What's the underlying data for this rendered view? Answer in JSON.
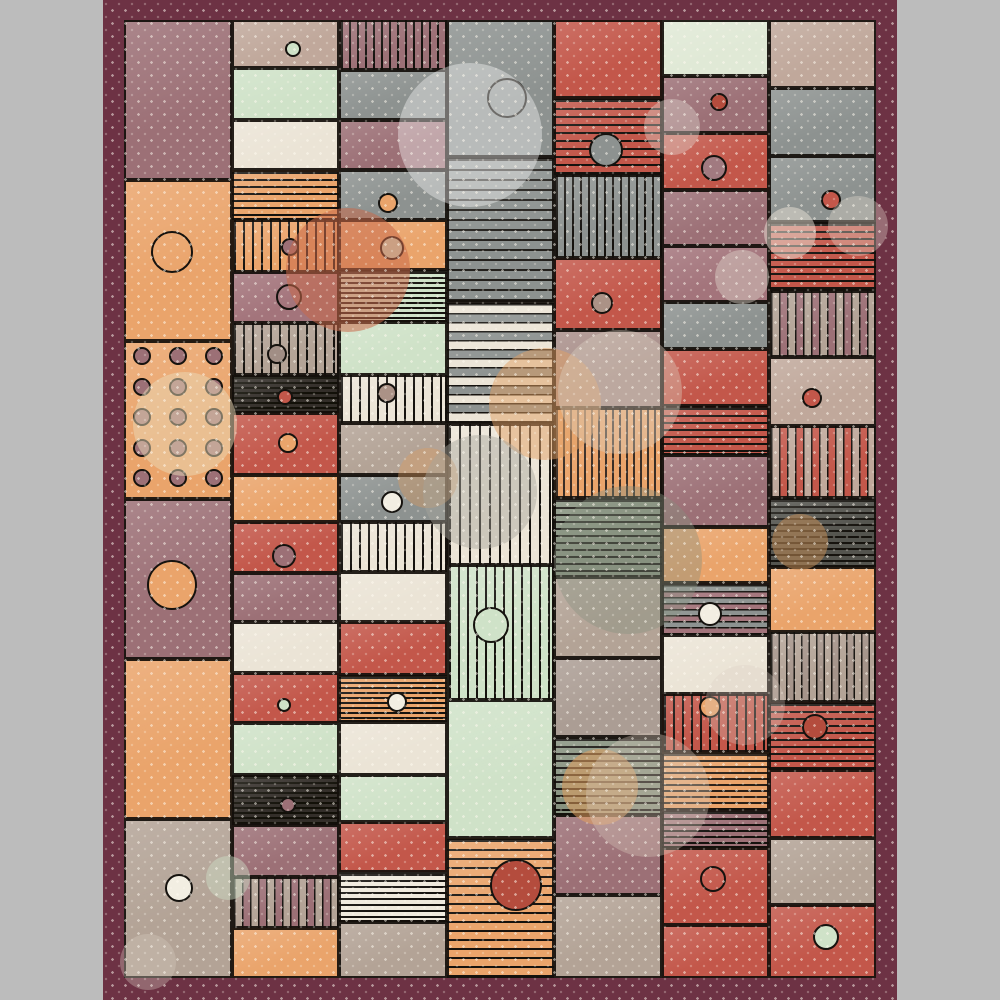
{
  "artwork": {
    "title_hint": "abstract patchwork quilt pattern, no visible text",
    "canvas": {
      "width": 1000,
      "height": 1000,
      "background": "#bcbcbc"
    }
  },
  "rug": {
    "x": 103,
    "y": 0,
    "w": 794,
    "h": 1000,
    "border_color": "#6d3244",
    "field": {
      "x": 124,
      "y": 20,
      "w": 752,
      "h": 958
    }
  },
  "palette": {
    "maroon": "#6d3244",
    "mauve": "#9c7076",
    "mauve2": "#a3747b",
    "mauveT": "#a98f8a",
    "orange": "#eaa46b",
    "red": "#c3574a",
    "redD": "#b44c3d",
    "mint": "#cfe2c8",
    "mintPale": "#e0e9d6",
    "cream": "#ebe4d6",
    "white": "#f2eee2",
    "gray": "#8d9290",
    "sage": "#87927f",
    "taupe": "#b3a396",
    "taupe2": "#ab9d94",
    "taupeP": "#c0a89b",
    "black": "#332e29",
    "dark": "#54544e",
    "ink": "#15120e"
  },
  "columns": [
    {
      "x": 124,
      "w": 108,
      "patches": [
        {
          "y": 20,
          "h": 160,
          "c": "mauve",
          "p": "solid"
        },
        {
          "y": 180,
          "h": 161,
          "c": "orange",
          "p": "solid",
          "circles": [
            {
              "x": 172,
              "y": 252,
              "r": 21,
              "fill": "none"
            }
          ]
        },
        {
          "y": 341,
          "h": 158,
          "c": "orange",
          "p": "solid",
          "grid": {
            "xs": [
              142,
              178,
              214
            ],
            "ys": [
              356,
              387,
              417,
              448,
              478
            ],
            "r": 9,
            "fill": "mauve"
          }
        },
        {
          "y": 499,
          "h": 160,
          "c": "mauve",
          "p": "solid",
          "circles": [
            {
              "x": 172,
              "y": 585,
              "r": 25,
              "fill": "orange"
            }
          ]
        },
        {
          "y": 659,
          "h": 160,
          "c": "orange",
          "p": "solid"
        },
        {
          "y": 819,
          "h": 159,
          "c": "taupe",
          "p": "solid",
          "circles": [
            {
              "x": 179,
              "y": 888,
              "r": 14,
              "fill": "white"
            }
          ]
        }
      ]
    },
    {
      "x": 232,
      "w": 107,
      "patches": [
        {
          "y": 20,
          "h": 48,
          "c": "taupeP",
          "p": "solid",
          "circles": [
            {
              "x": 293,
              "y": 49,
              "r": 8,
              "fill": "mint"
            }
          ]
        },
        {
          "y": 68,
          "h": 52,
          "c": "mint",
          "p": "solid"
        },
        {
          "y": 120,
          "h": 50,
          "c": "cream",
          "p": "solid"
        },
        {
          "y": 170,
          "h": 50,
          "c": "orange",
          "p": "hlines",
          "g": 7
        },
        {
          "y": 220,
          "h": 52,
          "c": "orange",
          "p": "vlines",
          "g": 9,
          "circles": [
            {
              "x": 290,
              "y": 247,
              "r": 9,
              "fill": "mauve"
            }
          ]
        },
        {
          "y": 272,
          "h": 51,
          "c": "mauve2",
          "p": "solid",
          "circles": [
            {
              "x": 289,
              "y": 297,
              "r": 13,
              "fill": "none"
            }
          ]
        },
        {
          "y": 323,
          "h": 52,
          "c": "taupe",
          "p": "vlines",
          "g": 9,
          "circles": [
            {
              "x": 277,
              "y": 354,
              "r": 10,
              "fill": "#a18e85"
            }
          ]
        },
        {
          "y": 375,
          "h": 38,
          "c": "black",
          "p": "hlines",
          "c2": "#121008",
          "g": 5,
          "circles": [
            {
              "x": 285,
              "y": 397,
              "r": 8,
              "fill": "red"
            }
          ]
        },
        {
          "y": 413,
          "h": 62,
          "c": "red",
          "p": "solid",
          "circles": [
            {
              "x": 288,
              "y": 443,
              "r": 10,
              "fill": "orange"
            }
          ]
        },
        {
          "y": 475,
          "h": 47,
          "c": "orange",
          "p": "solid"
        },
        {
          "y": 522,
          "h": 51,
          "c": "red",
          "p": "solid",
          "circles": [
            {
              "x": 284,
              "y": 556,
              "r": 12,
              "fill": "mauve"
            }
          ]
        },
        {
          "y": 573,
          "h": 49,
          "c": "mauve",
          "p": "solid"
        },
        {
          "y": 622,
          "h": 51,
          "c": "cream",
          "p": "solid"
        },
        {
          "y": 673,
          "h": 50,
          "c": "red",
          "p": "solid",
          "circles": [
            {
              "x": 284,
              "y": 705,
              "r": 7,
              "fill": "mint"
            }
          ]
        },
        {
          "y": 723,
          "h": 52,
          "c": "mint",
          "p": "solid"
        },
        {
          "y": 775,
          "h": 50,
          "c": "black",
          "p": "hlines",
          "c2": "#121008",
          "g": 5,
          "circles": [
            {
              "x": 288,
              "y": 805,
              "r": 8,
              "fill": "mauve"
            }
          ]
        },
        {
          "y": 825,
          "h": 52,
          "c": "mauve",
          "p": "solid"
        },
        {
          "y": 877,
          "h": 51,
          "c": "mauve",
          "p": "vbars",
          "c2": "taupe",
          "g": 16
        },
        {
          "y": 928,
          "h": 50,
          "c": "orange",
          "p": "solid"
        }
      ]
    },
    {
      "x": 339,
      "w": 108,
      "patches": [
        {
          "y": 20,
          "h": 50,
          "c": "mauve",
          "p": "vlines",
          "g": 8
        },
        {
          "y": 70,
          "h": 50,
          "c": "gray",
          "p": "solid"
        },
        {
          "y": 120,
          "h": 50,
          "c": "mauve",
          "p": "solid"
        },
        {
          "y": 170,
          "h": 50,
          "c": "gray",
          "p": "solid",
          "circles": [
            {
              "x": 388,
              "y": 203,
              "r": 10,
              "fill": "orange"
            }
          ]
        },
        {
          "y": 220,
          "h": 50,
          "c": "orange",
          "p": "solid",
          "circles": [
            {
              "x": 392,
              "y": 248,
              "r": 12,
              "fill": "mint"
            }
          ]
        },
        {
          "y": 270,
          "h": 52,
          "c": "mint",
          "p": "hlines",
          "g": 5
        },
        {
          "y": 322,
          "h": 53,
          "c": "mint",
          "p": "solid"
        },
        {
          "y": 375,
          "h": 48,
          "c": "cream",
          "p": "vlines",
          "g": 9,
          "circles": [
            {
              "x": 387,
              "y": 393,
              "r": 10,
              "fill": "#ab9286"
            }
          ]
        },
        {
          "y": 423,
          "h": 52,
          "c": "taupe",
          "p": "solid"
        },
        {
          "y": 475,
          "h": 47,
          "c": "gray",
          "p": "solid",
          "circles": [
            {
              "x": 392,
              "y": 502,
              "r": 11,
              "fill": "white"
            }
          ]
        },
        {
          "y": 522,
          "h": 50,
          "c": "cream",
          "p": "vlines",
          "g": 9
        },
        {
          "y": 572,
          "h": 50,
          "c": "cream",
          "p": "solid"
        },
        {
          "y": 622,
          "h": 53,
          "c": "red",
          "p": "solid"
        },
        {
          "y": 675,
          "h": 47,
          "c": "orange",
          "p": "hlines",
          "g": 5,
          "circles": [
            {
              "x": 397,
              "y": 702,
              "r": 10,
              "fill": "white"
            }
          ]
        },
        {
          "y": 722,
          "h": 53,
          "c": "cream",
          "p": "solid"
        },
        {
          "y": 775,
          "h": 47,
          "c": "mint",
          "p": "solid"
        },
        {
          "y": 822,
          "h": 50,
          "c": "red",
          "p": "solid"
        },
        {
          "y": 872,
          "h": 50,
          "c": "#efe9dc",
          "p": "hlines",
          "g": 6
        },
        {
          "y": 922,
          "h": 56,
          "c": "taupe",
          "p": "solid"
        }
      ]
    },
    {
      "x": 447,
      "w": 107,
      "patches": [
        {
          "y": 20,
          "h": 137,
          "c": "gray",
          "p": "solid",
          "circles": [
            {
              "x": 507,
              "y": 98,
              "r": 20,
              "fill": "none"
            }
          ]
        },
        {
          "y": 157,
          "h": 145,
          "c": "gray",
          "p": "hlines",
          "c2": "#23201c",
          "g": 10
        },
        {
          "y": 302,
          "h": 122,
          "c": "gray",
          "p": "hbars",
          "c2": "cream",
          "g": 18
        },
        {
          "y": 424,
          "h": 141,
          "c": "cream",
          "p": "vlines",
          "g": 10
        },
        {
          "y": 565,
          "h": 135,
          "c": "mint",
          "p": "vlines",
          "g": 9,
          "circles": [
            {
              "x": 491,
              "y": 625,
              "r": 18,
              "fill": "mint"
            }
          ]
        },
        {
          "y": 700,
          "h": 138,
          "c": "mint",
          "p": "solid"
        },
        {
          "y": 838,
          "h": 140,
          "c": "orange",
          "p": "hlines",
          "g": 9,
          "circles": [
            {
              "x": 516,
              "y": 885,
              "r": 26,
              "fill": "redD"
            }
          ]
        }
      ]
    },
    {
      "x": 554,
      "w": 108,
      "patches": [
        {
          "y": 20,
          "h": 78,
          "c": "red",
          "p": "solid"
        },
        {
          "y": 98,
          "h": 77,
          "c": "red",
          "p": "hlines",
          "g": 8,
          "circles": [
            {
              "x": 606,
              "y": 150,
              "r": 17,
              "fill": "gray"
            }
          ]
        },
        {
          "y": 175,
          "h": 83,
          "c": "gray",
          "p": "vlines",
          "g": 8
        },
        {
          "y": 258,
          "h": 72,
          "c": "red",
          "p": "solid",
          "circles": [
            {
              "x": 602,
              "y": 303,
              "r": 11,
              "fill": "#ab9286"
            }
          ]
        },
        {
          "y": 330,
          "h": 78,
          "c": "mauveT",
          "p": "solid"
        },
        {
          "y": 408,
          "h": 90,
          "c": "orange",
          "p": "vlines",
          "c2": "#3a2e26",
          "g": 7
        },
        {
          "y": 498,
          "h": 79,
          "c": "sage",
          "p": "hlines",
          "g": 7
        },
        {
          "y": 577,
          "h": 81,
          "c": "taupe",
          "p": "solid"
        },
        {
          "y": 658,
          "h": 79,
          "c": "taupe2",
          "p": "solid"
        },
        {
          "y": 737,
          "h": 78,
          "c": "sage",
          "p": "hlines",
          "g": 7
        },
        {
          "y": 815,
          "h": 80,
          "c": "mauve",
          "p": "solid"
        },
        {
          "y": 895,
          "h": 83,
          "c": "taupe",
          "p": "solid"
        }
      ]
    },
    {
      "x": 662,
      "w": 107,
      "patches": [
        {
          "y": 20,
          "h": 56,
          "c": "mintPale",
          "p": "solid"
        },
        {
          "y": 76,
          "h": 57,
          "c": "mauve",
          "p": "solid",
          "circles": [
            {
              "x": 719,
              "y": 102,
              "r": 9,
              "fill": "redD"
            }
          ]
        },
        {
          "y": 133,
          "h": 57,
          "c": "red",
          "p": "solid",
          "circles": [
            {
              "x": 714,
              "y": 168,
              "r": 13,
              "fill": "#a17a80"
            }
          ]
        },
        {
          "y": 190,
          "h": 56,
          "c": "mauve",
          "p": "solid"
        },
        {
          "y": 246,
          "h": 56,
          "c": "mauve2",
          "p": "solid"
        },
        {
          "y": 302,
          "h": 47,
          "c": "gray",
          "p": "solid"
        },
        {
          "y": 349,
          "h": 57,
          "c": "red",
          "p": "solid"
        },
        {
          "y": 406,
          "h": 49,
          "c": "red",
          "p": "hlines",
          "g": 7
        },
        {
          "y": 455,
          "h": 72,
          "c": "mauve",
          "p": "solid"
        },
        {
          "y": 527,
          "h": 56,
          "c": "orange",
          "p": "solid"
        },
        {
          "y": 583,
          "h": 52,
          "c": "mauve2",
          "p": "hbars",
          "c2": "gray",
          "g": 12,
          "circles": [
            {
              "x": 710,
              "y": 614,
              "r": 12,
              "fill": "white"
            }
          ]
        },
        {
          "y": 635,
          "h": 59,
          "c": "cream",
          "p": "solid"
        },
        {
          "y": 694,
          "h": 58,
          "c": "red",
          "p": "vlines",
          "g": 9,
          "circles": [
            {
              "x": 710,
              "y": 707,
              "r": 11,
              "fill": "orange"
            }
          ]
        },
        {
          "y": 752,
          "h": 58,
          "c": "orange",
          "p": "hlines",
          "c2": "#2a2017",
          "g": 6
        },
        {
          "y": 810,
          "h": 38,
          "c": "mauve",
          "p": "hlines",
          "g": 6
        },
        {
          "y": 848,
          "h": 77,
          "c": "red",
          "p": "solid",
          "circles": [
            {
              "x": 713,
              "y": 879,
              "r": 13,
              "fill": "none"
            }
          ]
        },
        {
          "y": 925,
          "h": 53,
          "c": "red",
          "p": "solid"
        }
      ]
    },
    {
      "x": 769,
      "w": 107,
      "patches": [
        {
          "y": 20,
          "h": 68,
          "c": "taupeP",
          "p": "solid"
        },
        {
          "y": 88,
          "h": 68,
          "c": "gray",
          "p": "solid"
        },
        {
          "y": 156,
          "h": 66,
          "c": "gray",
          "p": "solid",
          "circles": [
            {
              "x": 831,
              "y": 200,
              "r": 10,
              "fill": "red"
            }
          ]
        },
        {
          "y": 222,
          "h": 69,
          "c": "red",
          "p": "hlines",
          "g": 7
        },
        {
          "y": 291,
          "h": 66,
          "c": "mauve",
          "p": "vbars",
          "c2": "taupe",
          "g": 16
        },
        {
          "y": 357,
          "h": 69,
          "c": "taupeP",
          "p": "solid",
          "circles": [
            {
              "x": 812,
              "y": 398,
              "r": 10,
              "fill": "red"
            }
          ]
        },
        {
          "y": 426,
          "h": 72,
          "c": "red",
          "p": "vbars",
          "c2": "taupeP",
          "g": 16
        },
        {
          "y": 498,
          "h": 69,
          "c": "dark",
          "p": "hlines",
          "c2": "#16130e",
          "g": 6
        },
        {
          "y": 567,
          "h": 65,
          "c": "orange",
          "p": "solid"
        },
        {
          "y": 632,
          "h": 70,
          "c": "taupe",
          "p": "vbars",
          "c2": "#a5948a",
          "g": 15
        },
        {
          "y": 702,
          "h": 68,
          "c": "red",
          "p": "hlines",
          "g": 7,
          "circles": [
            {
              "x": 815,
              "y": 727,
              "r": 13,
              "fill": "redD"
            }
          ]
        },
        {
          "y": 770,
          "h": 68,
          "c": "red",
          "p": "solid"
        },
        {
          "y": 838,
          "h": 67,
          "c": "taupe",
          "p": "solid"
        },
        {
          "y": 905,
          "h": 73,
          "c": "red",
          "p": "solid",
          "circles": [
            {
              "x": 826,
              "y": 937,
              "r": 13,
              "fill": "mint"
            }
          ]
        }
      ]
    }
  ],
  "blobs": [
    {
      "x": 470,
      "y": 135,
      "r": 72,
      "c": "#ffffff",
      "o": 0.38
    },
    {
      "x": 348,
      "y": 270,
      "r": 62,
      "c": "#c96a4a",
      "o": 0.55
    },
    {
      "x": 185,
      "y": 424,
      "r": 52,
      "c": "#e9dab8",
      "o": 0.5
    },
    {
      "x": 545,
      "y": 404,
      "r": 56,
      "c": "#e1a064",
      "o": 0.5
    },
    {
      "x": 620,
      "y": 392,
      "r": 62,
      "c": "#ded2c2",
      "o": 0.38
    },
    {
      "x": 428,
      "y": 478,
      "r": 30,
      "c": "#dc9a60",
      "o": 0.4
    },
    {
      "x": 480,
      "y": 492,
      "r": 57,
      "c": "#a7a49b",
      "o": 0.45
    },
    {
      "x": 628,
      "y": 560,
      "r": 74,
      "c": "#87927f",
      "o": 0.4
    },
    {
      "x": 600,
      "y": 787,
      "r": 38,
      "c": "#e4a05e",
      "o": 0.55
    },
    {
      "x": 648,
      "y": 795,
      "r": 62,
      "c": "#d9ccbd",
      "o": 0.35
    },
    {
      "x": 745,
      "y": 705,
      "r": 40,
      "c": "#d9cec2",
      "o": 0.3
    },
    {
      "x": 790,
      "y": 233,
      "r": 26,
      "c": "#ece3d8",
      "o": 0.5
    },
    {
      "x": 742,
      "y": 277,
      "r": 27,
      "c": "#ded5ca",
      "o": 0.45
    },
    {
      "x": 672,
      "y": 127,
      "r": 28,
      "c": "#e2dad1",
      "o": 0.4
    },
    {
      "x": 858,
      "y": 226,
      "r": 30,
      "c": "#e8ddd2",
      "o": 0.35
    },
    {
      "x": 800,
      "y": 542,
      "r": 28,
      "c": "#c08b55",
      "o": 0.55
    },
    {
      "x": 148,
      "y": 962,
      "r": 28,
      "c": "#d8ccc0",
      "o": 0.35
    },
    {
      "x": 228,
      "y": 878,
      "r": 22,
      "c": "#cfe0c8",
      "o": 0.45
    }
  ],
  "dots": {
    "color": "rgba(255,250,240,0.5)",
    "spacing": 13
  }
}
